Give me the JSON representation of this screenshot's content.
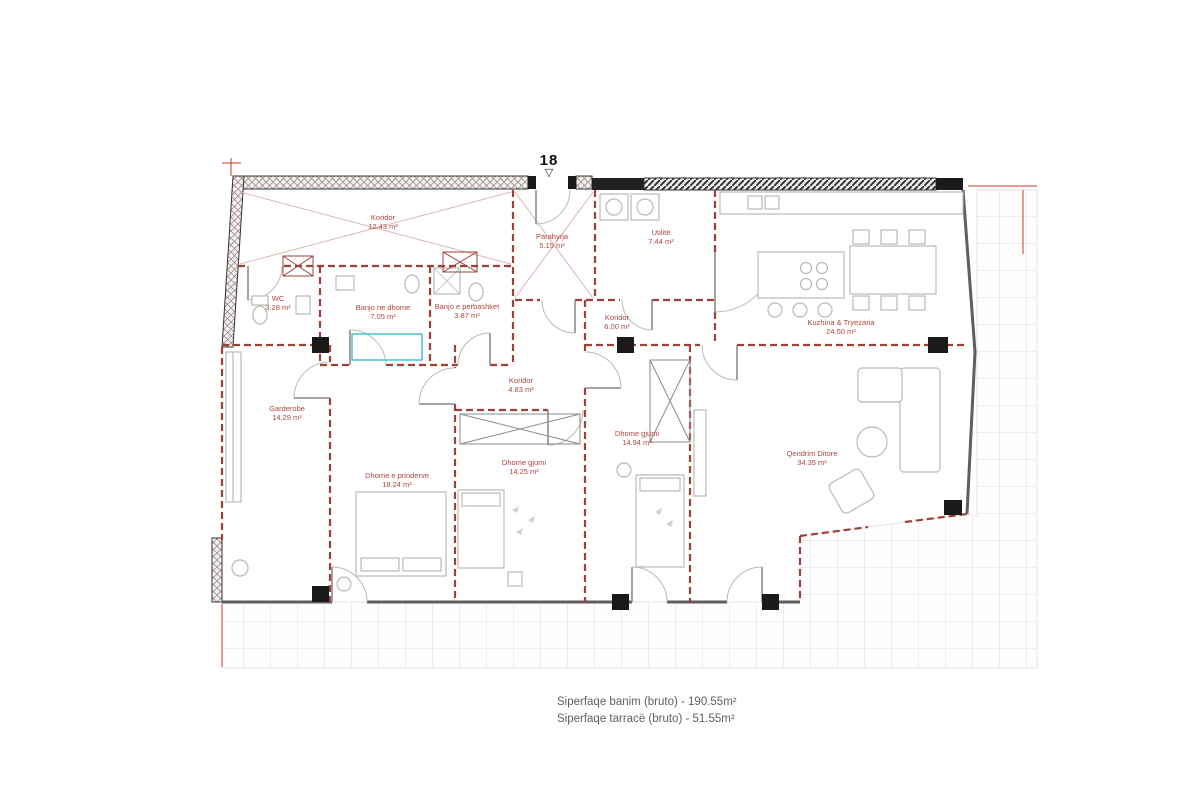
{
  "unit_marker": {
    "number": "18"
  },
  "icons": {
    "entry_triangle": "▽"
  },
  "rooms": [
    {
      "name": "Koridor",
      "area": "12.43 m²"
    },
    {
      "name": "Parahyrja",
      "area": "5.15 m²"
    },
    {
      "name": "Utilitë",
      "area": "7.44 m²"
    },
    {
      "name": "WC",
      "area": "3.28 m²"
    },
    {
      "name": "Banjo ne dhome",
      "area": "7.05 m²"
    },
    {
      "name": "Banjo e perbashket",
      "area": "3.87 m²"
    },
    {
      "name": "Koridor",
      "area": "6.00 m²"
    },
    {
      "name": "Kuzhina & Tryezaria",
      "area": "24.50 m²"
    },
    {
      "name": "Koridor",
      "area": "4.83 m²"
    },
    {
      "name": "Garderobe",
      "area": "14.29 m²"
    },
    {
      "name": "Dhome e prinderve",
      "area": "18.24 m²"
    },
    {
      "name": "Dhome gjumi",
      "area": "14.25 m²"
    },
    {
      "name": "Dhome gjumi",
      "area": "14.94 m²"
    },
    {
      "name": "Qendrim Ditore",
      "area": "34.35 m²"
    }
  ],
  "footer": {
    "line1": "Siperfaqe banim (bruto) - 190.55m²",
    "line2": "Siperfaqe tarracë (bruto) - 51.55m²"
  },
  "colors": {
    "interior_wall_dashed": "#9c4038",
    "room_label_text": "#b0453e",
    "dimension_line": "#c0392b",
    "terrace_tile_line": "#dcdcdc",
    "furniture_outline": "#b9b9b9",
    "shower_accent_teal": "#49c3cf",
    "column_black": "#1a1a1a"
  }
}
